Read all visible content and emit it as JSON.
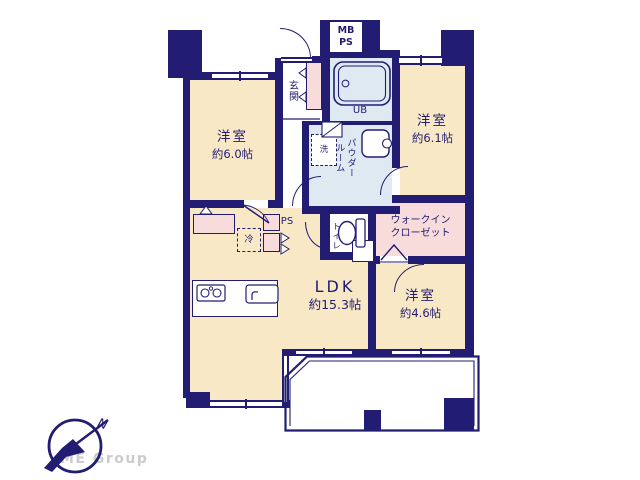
{
  "rooms": {
    "bedroom_a": {
      "name": "洋室",
      "size": "約6.0帖"
    },
    "bedroom_b": {
      "name": "洋室",
      "size": "約6.1帖"
    },
    "bedroom_c": {
      "name": "洋室",
      "size": "約4.6帖"
    },
    "ldk": {
      "name": "LDK",
      "size": "約15.3帖"
    },
    "walk_in_closet": {
      "line1": "ウォークイン",
      "line2": "クローゼット"
    },
    "entrance": {
      "label": "玄関"
    },
    "unit_bath": {
      "label": "UB"
    },
    "meter_box": {
      "line1": "MB",
      "line2": "PS"
    },
    "powder_room": {
      "line1": "パウダー",
      "line2": "ルーム"
    },
    "laundry": {
      "label": "洗"
    },
    "toilet": {
      "label": "トイレ"
    },
    "pipe_space": {
      "label": "PS"
    },
    "refrigerator": {
      "label": "冷"
    }
  },
  "logo": {
    "company": "ME Group",
    "compass_north": "N"
  },
  "colors": {
    "wall": "#221d72",
    "room_cream": "#f8e8c5",
    "wet_blue": "#dfe9f2",
    "pink": "#f8dbdb",
    "logo_gray": "#cccccc"
  }
}
